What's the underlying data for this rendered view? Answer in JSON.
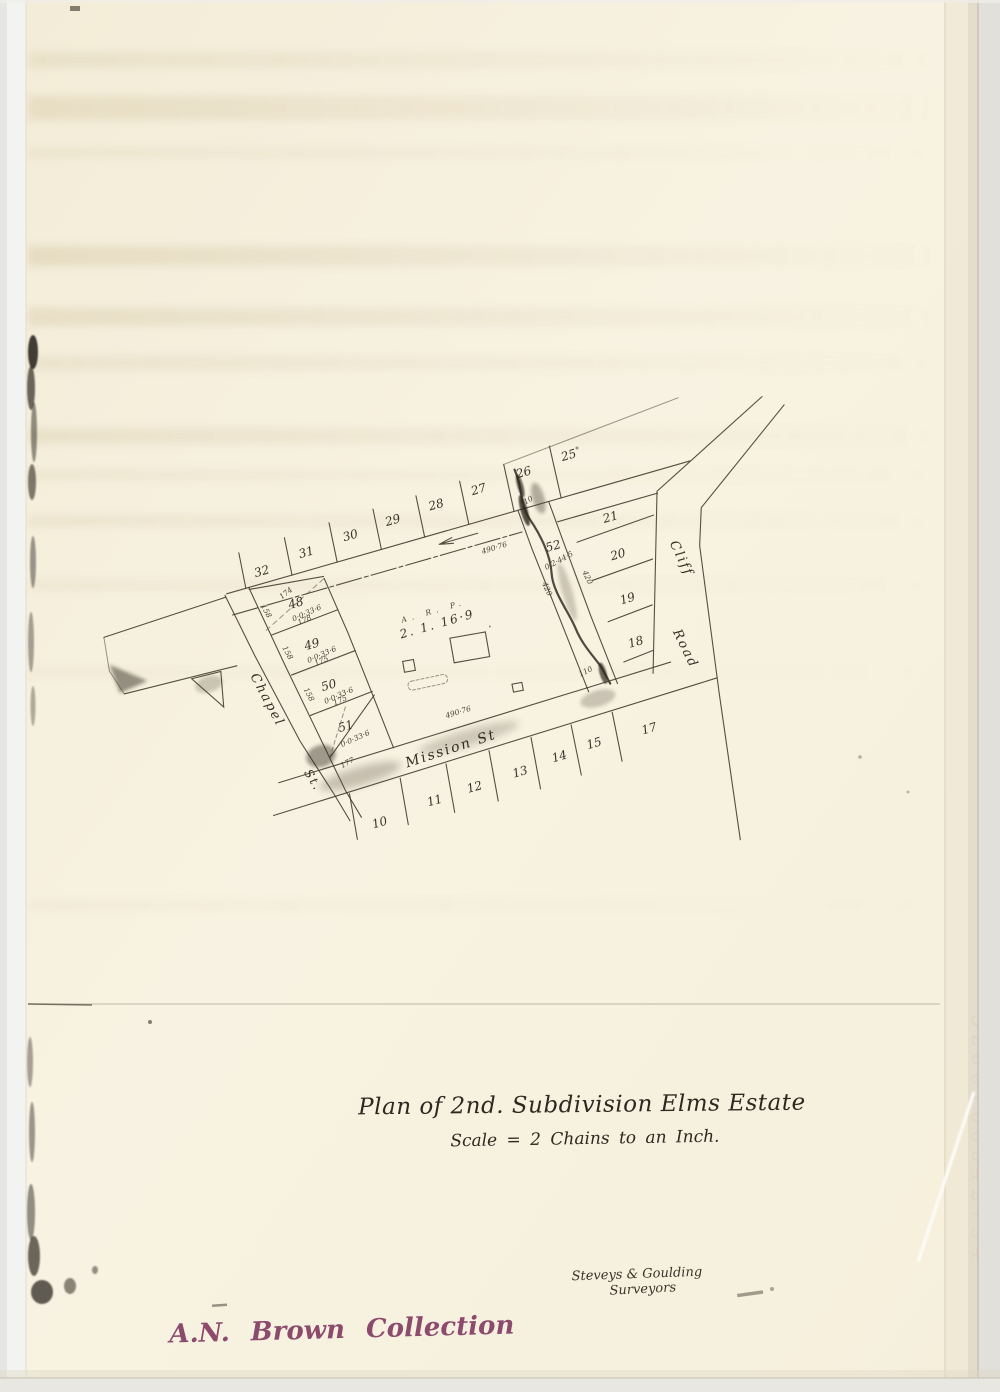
{
  "page": {
    "title": "Plan of 2nd. Subdivision Elms Estate",
    "scale_note": "Scale = 2 Chains to an Inch.",
    "surveyors_line1": "Steveys & Goulding",
    "surveyors_line2": "Surveyors",
    "collection_stamp": "A.N. Brown Collection",
    "edge_number": "3200100042794"
  },
  "map": {
    "streets": {
      "top_dim": "490·76",
      "chapel": {
        "name": "Chapel",
        "suffix": "St."
      },
      "mission": {
        "name": "Mission St",
        "dim": "490·76"
      },
      "cliff": {
        "name": "Cliff",
        "suffix": "Road"
      }
    },
    "top_lots": [
      "32",
      "31",
      "30",
      "29",
      "28",
      "27",
      "26",
      "25"
    ],
    "right_lots": [
      "21",
      "20",
      "19",
      "18"
    ],
    "bottom_lots": [
      "10",
      "11",
      "12",
      "13",
      "14",
      "15",
      "17"
    ],
    "left_lots": [
      {
        "number": "48",
        "area": "0·0·33·6",
        "top_dim": "174",
        "side_dim": "158"
      },
      {
        "number": "49",
        "area": "0·0·33·6",
        "top_dim": "178",
        "side_dim": "158"
      },
      {
        "number": "50",
        "area": "0·0·33·6",
        "top_dim": "175",
        "side_dim": "158"
      },
      {
        "number": "51",
        "area": "0·0·33·6",
        "top_dim": "175",
        "side_dim": "177"
      }
    ],
    "creek_lot": {
      "number": "52",
      "area": "0·2·44·5",
      "top_dim": "110",
      "bottom_dim": "110",
      "left_dim": "420",
      "right_dim": "420"
    },
    "central_lot": {
      "header": "A. R. P.",
      "area": "2. 1. 16·9"
    }
  }
}
